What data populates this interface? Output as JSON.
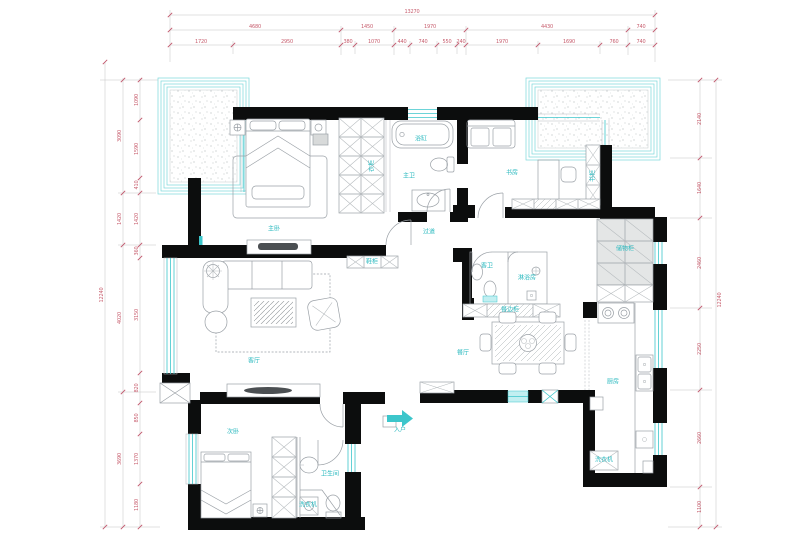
{
  "title": "apartment-floor-plan",
  "colors": {
    "wall": "#0c0d0d",
    "furniture_line": "#9aa0a6",
    "window_cyan": "#3cc6cb",
    "balcony_border": "#7ad8db",
    "dimension_text": "#c75e6e",
    "cabinet_fill": "#e4e6e6",
    "background": "#ffffff"
  },
  "room_labels": [
    {
      "id": "master-bedroom",
      "text": "主卧",
      "x": 274,
      "y": 229
    },
    {
      "id": "master-wardrobe",
      "text": "衣柜",
      "x": 372,
      "y": 166,
      "rot": -90
    },
    {
      "id": "bathtub",
      "text": "浴缸",
      "x": 421,
      "y": 139
    },
    {
      "id": "master-bath",
      "text": "主卫",
      "x": 409,
      "y": 176
    },
    {
      "id": "study",
      "text": "书房",
      "x": 512,
      "y": 173
    },
    {
      "id": "bookcase",
      "text": "书柜",
      "x": 593,
      "y": 176,
      "rot": -90
    },
    {
      "id": "storage-cabinet",
      "text": "储物柜",
      "x": 625,
      "y": 249
    },
    {
      "id": "hallway",
      "text": "过道",
      "x": 429,
      "y": 232
    },
    {
      "id": "shoe-cabinet",
      "text": "鞋柜",
      "x": 372,
      "y": 262
    },
    {
      "id": "living-room",
      "text": "客厅",
      "x": 254,
      "y": 361
    },
    {
      "id": "guest-bath",
      "text": "客卫",
      "x": 487,
      "y": 266
    },
    {
      "id": "shower-room",
      "text": "淋浴房",
      "x": 527,
      "y": 278
    },
    {
      "id": "sideboard",
      "text": "餐边柜",
      "x": 510,
      "y": 310
    },
    {
      "id": "dining-room",
      "text": "餐厅",
      "x": 463,
      "y": 353
    },
    {
      "id": "kitchen",
      "text": "厨房",
      "x": 613,
      "y": 382
    },
    {
      "id": "washer-kitchen",
      "text": "洗衣机",
      "x": 604,
      "y": 460
    },
    {
      "id": "bedroom-2",
      "text": "次卧",
      "x": 233,
      "y": 432
    },
    {
      "id": "bathroom-2",
      "text": "卫生间",
      "x": 330,
      "y": 474
    },
    {
      "id": "washer-2",
      "text": "洗衣机",
      "x": 308,
      "y": 505
    },
    {
      "id": "entry",
      "text": "入户",
      "x": 400,
      "y": 430
    }
  ],
  "dimensions": {
    "top": {
      "overall": {
        "v": "13270",
        "x": 412,
        "y": 12
      },
      "row2": [
        {
          "v": "4680",
          "x": 255,
          "y": 27
        },
        {
          "v": "1450",
          "x": 367,
          "y": 27
        },
        {
          "v": "1970",
          "x": 430,
          "y": 27
        },
        {
          "v": "4430",
          "x": 547,
          "y": 27
        },
        {
          "v": "740",
          "x": 641,
          "y": 27
        }
      ],
      "row3": [
        {
          "v": "1720",
          "x": 201,
          "y": 42
        },
        {
          "v": "2950",
          "x": 287,
          "y": 42
        },
        {
          "v": "380",
          "x": 348,
          "y": 42
        },
        {
          "v": "1070",
          "x": 374,
          "y": 42
        },
        {
          "v": "440",
          "x": 402,
          "y": 42
        },
        {
          "v": "740",
          "x": 423,
          "y": 42
        },
        {
          "v": "550",
          "x": 447,
          "y": 42
        },
        {
          "v": "240",
          "x": 461,
          "y": 42
        },
        {
          "v": "1970",
          "x": 502,
          "y": 42
        },
        {
          "v": "1690",
          "x": 569,
          "y": 42
        },
        {
          "v": "760",
          "x": 614,
          "y": 42
        },
        {
          "v": "740",
          "x": 641,
          "y": 42
        }
      ]
    },
    "left": {
      "overall": {
        "v": "12240",
        "x": 102,
        "y": 295,
        "rot": -90
      },
      "row2": [
        {
          "v": "3090",
          "x": 120,
          "y": 136,
          "rot": -90
        },
        {
          "v": "1420",
          "x": 120,
          "y": 219,
          "rot": -90
        },
        {
          "v": "4020",
          "x": 120,
          "y": 318,
          "rot": -90
        },
        {
          "v": "3690",
          "x": 120,
          "y": 459,
          "rot": -90
        }
      ],
      "row3": [
        {
          "v": "1090",
          "x": 137,
          "y": 100,
          "rot": -90
        },
        {
          "v": "1590",
          "x": 137,
          "y": 149,
          "rot": -90
        },
        {
          "v": "410",
          "x": 137,
          "y": 185,
          "rot": -90
        },
        {
          "v": "1420",
          "x": 137,
          "y": 219,
          "rot": -90
        },
        {
          "v": "360",
          "x": 137,
          "y": 251,
          "rot": -90
        },
        {
          "v": "3150",
          "x": 137,
          "y": 315,
          "rot": -90
        },
        {
          "v": "820",
          "x": 137,
          "y": 388,
          "rot": -90
        },
        {
          "v": "850",
          "x": 137,
          "y": 418,
          "rot": -90
        },
        {
          "v": "1370",
          "x": 137,
          "y": 459,
          "rot": -90
        },
        {
          "v": "1180",
          "x": 137,
          "y": 505,
          "rot": -90
        }
      ]
    },
    "right": {
      "overall": {
        "v": "12240",
        "x": 720,
        "y": 300,
        "rot": -90
      },
      "row2": [
        {
          "v": "2140",
          "x": 700,
          "y": 119,
          "rot": -90
        },
        {
          "v": "1640",
          "x": 700,
          "y": 188,
          "rot": -90
        },
        {
          "v": "2460",
          "x": 700,
          "y": 263,
          "rot": -90
        },
        {
          "v": "2250",
          "x": 700,
          "y": 349,
          "rot": -90
        },
        {
          "v": "2660",
          "x": 700,
          "y": 438,
          "rot": -90
        },
        {
          "v": "1100",
          "x": 700,
          "y": 507,
          "rot": -90
        }
      ]
    },
    "ticks": [
      {
        "dir": "h",
        "y": 15,
        "xs": [
          170,
          655
        ]
      },
      {
        "dir": "h",
        "y": 30,
        "xs": [
          170,
          341,
          394,
          466,
          628,
          655
        ]
      },
      {
        "dir": "h",
        "y": 45,
        "xs": [
          170,
          233,
          341,
          355,
          394,
          410,
          437,
          457,
          466,
          538,
          600,
          628,
          655
        ]
      },
      {
        "dir": "v",
        "x": 105,
        "ys": [
          62,
          527
        ]
      },
      {
        "dir": "v",
        "x": 123,
        "ys": [
          80,
          193,
          245,
          392,
          527
        ]
      },
      {
        "dir": "v",
        "x": 140,
        "ys": [
          80,
          120,
          178,
          193,
          245,
          258,
          373,
          403,
          434,
          484,
          527
        ]
      },
      {
        "dir": "v",
        "x": 700,
        "ys": [
          80,
          158,
          218,
          308,
          390,
          487,
          527
        ]
      },
      {
        "dir": "v",
        "x": 716,
        "ys": [
          80,
          527
        ]
      }
    ]
  }
}
